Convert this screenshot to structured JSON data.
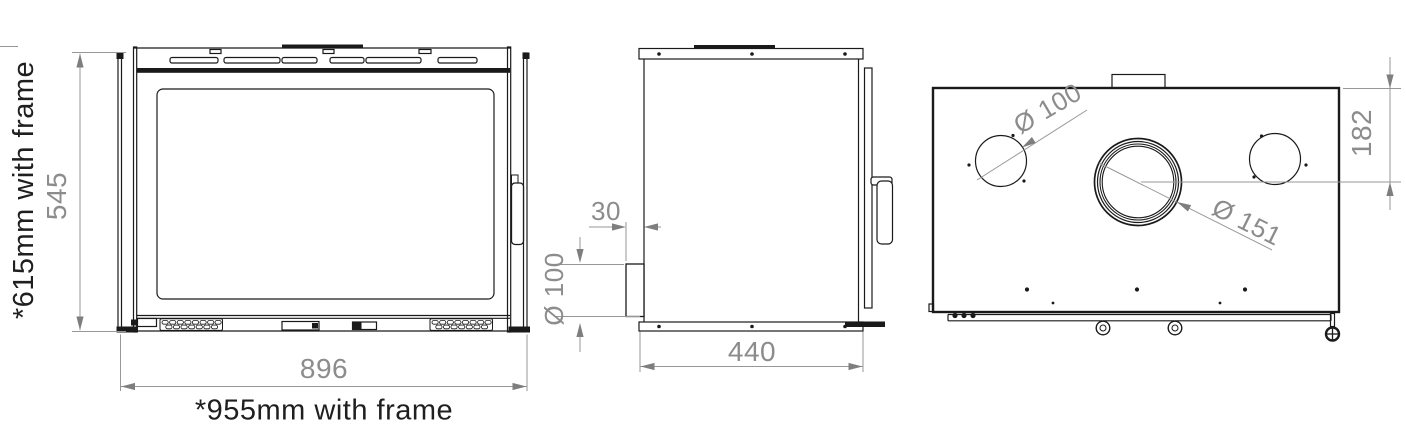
{
  "drawing": {
    "front": {
      "height": "545",
      "height_with_frame": "*615mm with frame",
      "width": "896",
      "width_with_frame": "*955mm with frame"
    },
    "side": {
      "rear_outlet_offset": "30",
      "rear_outlet_diameter": "Ø 100",
      "depth": "440"
    },
    "rear": {
      "side_outlet_diameter": "Ø 100",
      "flue_diameter": "Ø 151",
      "flue_offset_from_top": "182"
    },
    "colors": {
      "line": "#1a1a1a",
      "dimension": "#8c8c8c",
      "background": "#ffffff"
    }
  }
}
